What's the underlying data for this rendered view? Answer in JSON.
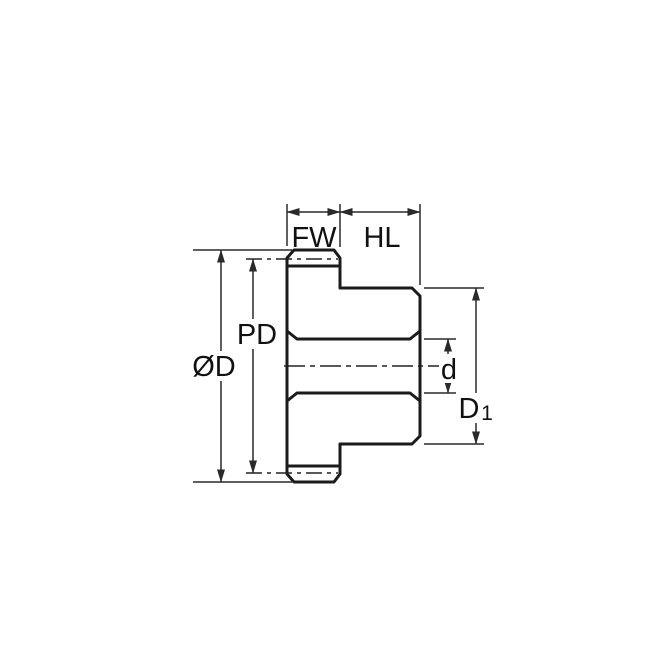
{
  "diagram": {
    "type": "gear-cross-section-dimension-drawing",
    "colors": {
      "body_fill": "#C9E8F9",
      "outline": "#1B1B1B",
      "dimension_line": "#2A2A2A",
      "label_text": "#111111",
      "background": "#FFFFFF"
    },
    "labels": {
      "face_width": "FW",
      "hub_length": "HL",
      "outside_diameter": "ØD",
      "pitch_diameter": "PD",
      "bore_diameter": "d",
      "hub_diameter_main": "D",
      "hub_diameter_sub": "1"
    }
  }
}
